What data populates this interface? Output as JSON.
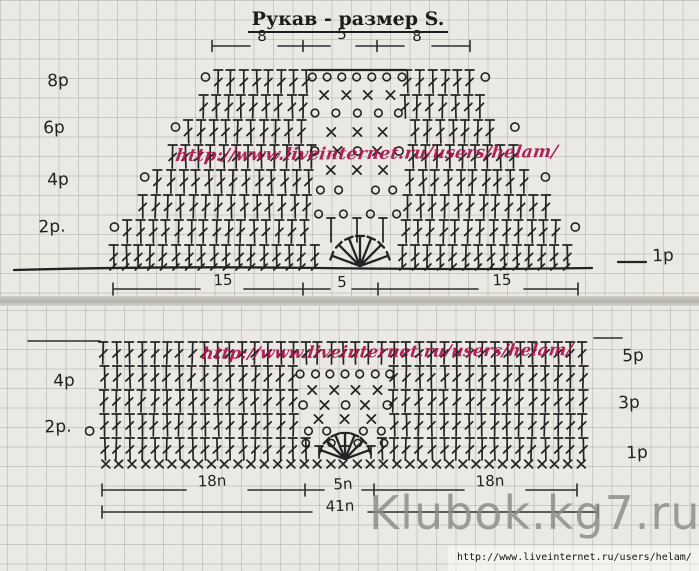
{
  "title": "Рукав - размер S.",
  "top_chart": {
    "rows": 8,
    "top_measures": [
      "8",
      "5",
      "8"
    ],
    "bottom_measures": [
      "15",
      "5",
      "15"
    ],
    "left_labels": [
      "8p",
      "6p",
      "4p",
      "2p."
    ],
    "right_label": "1p",
    "watermark": "http://www.liveinternet.ru/users/helam/"
  },
  "bottom_chart": {
    "rows": 5,
    "left_labels": [
      "4p",
      "2p."
    ],
    "right_labels": [
      "5p",
      "3p",
      "1p"
    ],
    "bottom_measures": [
      "18n",
      "5n",
      "18n"
    ],
    "total_measure": "41n",
    "watermark": "http://www.liveinternet.ru/users/helam/"
  },
  "watermarks": {
    "site": "Klubok.kg7.ru",
    "source_url": "http://www.liveinternet.ru/users/helam/"
  },
  "colors": {
    "ink": "#232323",
    "watermark_red": "#a8134f",
    "watermark_gray": "#8a8a8a",
    "paper": "#ebe9e2"
  }
}
